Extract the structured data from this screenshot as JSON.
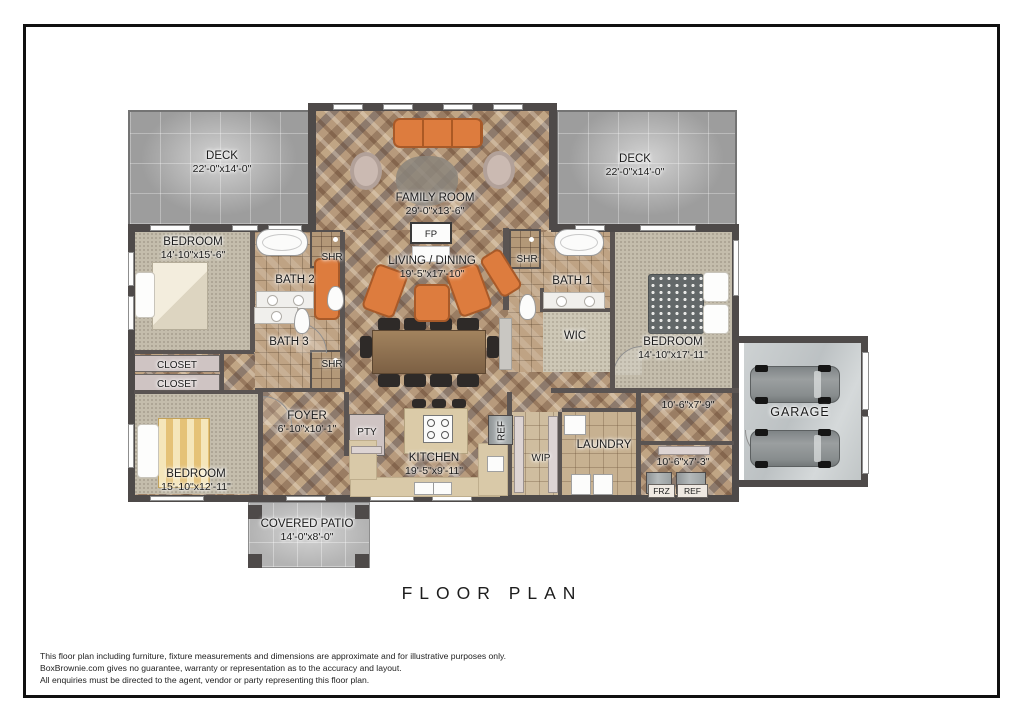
{
  "title": "FLOOR PLAN",
  "disclaimer": {
    "line1": "This floor plan including furniture, fixture measurements and dimensions are approximate and for illustrative purposes only.",
    "line2": "BoxBrownie.com gives no guarantee, warranty or representation as to the accuracy and layout.",
    "line3": "All enquiries must be directed to the agent, vendor or party representing this floor plan."
  },
  "rooms": {
    "deck_left": {
      "name": "DECK",
      "dims": "22'-0\"x14'-0\""
    },
    "deck_right": {
      "name": "DECK",
      "dims": "22'-0\"x14'-0\""
    },
    "family_room": {
      "name": "FAMILY ROOM",
      "dims": "29'-0\"x13'-6\""
    },
    "living_dining": {
      "name": "LIVING / DINING",
      "dims": "19'-5\"x17'-10\""
    },
    "bedroom_top_left": {
      "name": "BEDROOM",
      "dims": "14'-10\"x15'-6\""
    },
    "bedroom_bottom_left": {
      "name": "BEDROOM",
      "dims": "15'-10\"x12'-11\""
    },
    "bedroom_right": {
      "name": "BEDROOM",
      "dims": "14'-10\"x17'-11\""
    },
    "bath_1": {
      "name": "BATH 1"
    },
    "bath_2": {
      "name": "BATH 2"
    },
    "bath_3": {
      "name": "BATH 3"
    },
    "shower": {
      "name": "SHR"
    },
    "wic": {
      "name": "WIC"
    },
    "closet": {
      "name": "CLOSET"
    },
    "foyer": {
      "name": "FOYER",
      "dims": "6'-10\"x10'-1\""
    },
    "pantry": {
      "name": "PTY"
    },
    "kitchen": {
      "name": "KITCHEN",
      "dims": "19'-5\"x9'-11\""
    },
    "wip": {
      "name": "WIP"
    },
    "laundry": {
      "name": "LAUNDRY"
    },
    "flex_room_top": {
      "dims": "10'-6\"x7'-9\""
    },
    "flex_room_bottom": {
      "dims": "10'-6\"x7'-3\""
    },
    "garage": {
      "name": "GARAGE"
    },
    "covered_patio": {
      "name": "COVERED PATIO",
      "dims": "14'-0\"x8'-0\""
    }
  },
  "appliances": {
    "fireplace": "FP",
    "kitchen_fridge": "REF",
    "freezer": "FRZ",
    "second_fridge": "REF"
  },
  "colors": {
    "wall": "#4e4a49",
    "sofa_accent": "#dd7c3e",
    "wood_floor": "#a08468",
    "deck": "#9d9d9d",
    "carpet": "#c4bdac",
    "garage_floor": "#c6cbcc",
    "bed_yellow": "#e8c877"
  }
}
